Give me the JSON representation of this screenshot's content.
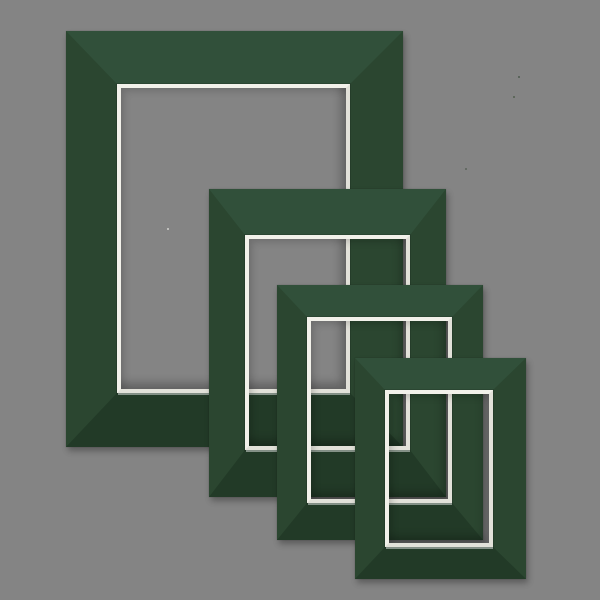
{
  "scene": {
    "description": "Product photo of four overlapping dark green picture-frame mat boards with white bevel-cut rectangular openings, arranged diagonally from largest (top-left) to smallest (bottom-right) on a plain gray background",
    "background_color": "#848484",
    "mat_color": "#2b4630",
    "mat_color_light_edge": "#31503a",
    "mat_color_dark_edge": "#223a27",
    "bevel_light": "#f2f1ea",
    "bevel_shade": "#e2e1d9",
    "bevel_cut_line": "rgba(0,0,0,0.12)",
    "outer_shadow": "2px 4px 6px rgba(0,0,0,0.30), 0 0 1px rgba(0,0,0,0.25)",
    "opening_inner_shadow": "inset -5px -6px 9px rgba(0,0,0,0.25), inset 4px 4px 7px rgba(0,0,0,0.13)",
    "bottom_edge_highlight": "rgba(255,255,255,0.45)",
    "mat_count": "4"
  },
  "mats": [
    {
      "name": "mat-board-1-largest",
      "left": 66,
      "top": 31,
      "width": 337,
      "height": 416,
      "border": {
        "top": 53,
        "right": 53,
        "bottom": 54,
        "left": 51
      },
      "bevel": 4
    },
    {
      "name": "mat-board-2-large",
      "left": 209,
      "top": 189,
      "width": 237,
      "height": 308,
      "border": {
        "top": 46,
        "right": 36,
        "bottom": 47,
        "left": 36
      },
      "bevel": 4
    },
    {
      "name": "mat-board-3-medium",
      "left": 277,
      "top": 285,
      "width": 206,
      "height": 255,
      "border": {
        "top": 32,
        "right": 31,
        "bottom": 37,
        "left": 30
      },
      "bevel": 4
    },
    {
      "name": "mat-board-4-smallest",
      "left": 355,
      "top": 358,
      "width": 171,
      "height": 221,
      "border": {
        "top": 32,
        "right": 33,
        "bottom": 32,
        "left": 30
      },
      "bevel": 4
    }
  ],
  "dust_specks": [
    {
      "x": 518,
      "y": 76,
      "color": "#4d5a4e"
    },
    {
      "x": 513,
      "y": 96,
      "color": "#53604f"
    },
    {
      "x": 465,
      "y": 168,
      "color": "#5a645a"
    },
    {
      "x": 167,
      "y": 228,
      "color": "#d2d2cf"
    }
  ]
}
